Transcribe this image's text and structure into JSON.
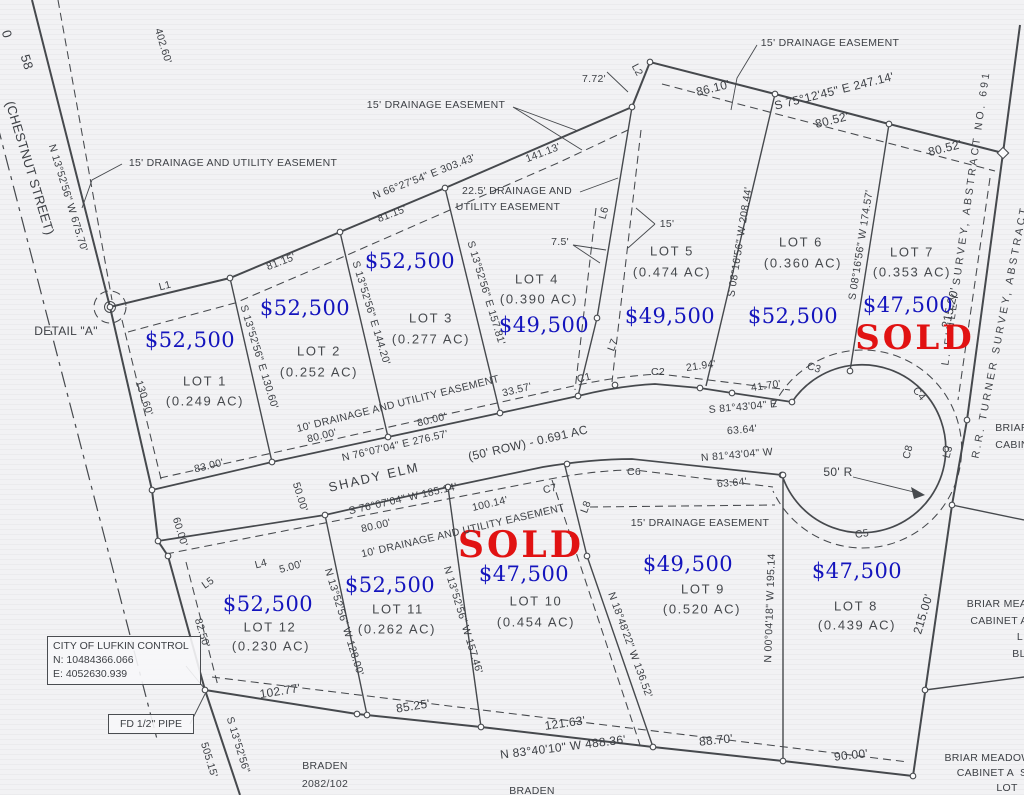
{
  "colors": {
    "price_blue": "#1414bd",
    "sold_red": "#e11212",
    "ink": "#3d4045",
    "paper": "#f2f2f4"
  },
  "control_box": {
    "title": "CITY OF LUFKIN CONTROL",
    "northing": "N: 10484366.066",
    "easting": "E: 4052630.939"
  },
  "pipe_box": {
    "label": "FD 1/2\" PIPE"
  },
  "labels": [
    {
      "n": "dim-402-60",
      "t": "402.60'",
      "x": 163,
      "y": 46,
      "r": 73
    },
    {
      "n": "street-number-partial",
      "t": "0",
      "x": 7,
      "y": 34,
      "r": 73,
      "s": 13
    },
    {
      "n": "street-number",
      "t": "58",
      "x": 27,
      "y": 62,
      "r": 73,
      "s": 13
    },
    {
      "n": "street-name",
      "t": "(CHESTNUT STREET)",
      "x": 30,
      "y": 168,
      "r": 73,
      "s": 13
    },
    {
      "n": "bearing-chestnut",
      "t": "N 13°52'56\" W 675.70'",
      "x": 68,
      "y": 198,
      "r": 73
    },
    {
      "n": "easement-nw-label",
      "t": "15' DRAINAGE AND UTILITY EASEMENT",
      "x": 233,
      "y": 163
    },
    {
      "n": "easement-n-label",
      "t": "15' DRAINAGE EASEMENT",
      "x": 436,
      "y": 105
    },
    {
      "n": "dim-7-72",
      "t": "7.72'",
      "x": 594,
      "y": 79
    },
    {
      "n": "line-l2",
      "t": "L2",
      "x": 637,
      "y": 70,
      "r": 62
    },
    {
      "n": "bearing-n-boundary",
      "t": "N 66°27'54\" E 303.43'",
      "x": 424,
      "y": 177,
      "r": -21
    },
    {
      "n": "dim-141-13",
      "t": "141.13'",
      "x": 543,
      "y": 153,
      "r": -21
    },
    {
      "n": "easement-22-label-1",
      "t": "22.5' DRAINAGE AND",
      "x": 517,
      "y": 191
    },
    {
      "n": "easement-22-label-2",
      "t": "UTILITY EASEMENT",
      "x": 508,
      "y": 207
    },
    {
      "n": "dim-81-15-a",
      "t": "81.15'",
      "x": 281,
      "y": 262,
      "r": -21
    },
    {
      "n": "dim-81-15-b",
      "t": "81.15'",
      "x": 392,
      "y": 214,
      "r": -21
    },
    {
      "n": "easement-ne-label",
      "t": "15' DRAINAGE EASEMENT",
      "x": 830,
      "y": 43
    },
    {
      "n": "dim-86-10",
      "t": "86.10'",
      "x": 713,
      "y": 88,
      "r": -14,
      "s": 12
    },
    {
      "n": "bearing-ne-boundary",
      "t": "S 75°12'45\" E 247.14'",
      "x": 834,
      "y": 91,
      "r": -14,
      "s": 12
    },
    {
      "n": "dim-80-52-a",
      "t": "80.52'",
      "x": 832,
      "y": 120,
      "r": -14,
      "s": 12
    },
    {
      "n": "dim-80-52-b",
      "t": "80.52'",
      "x": 945,
      "y": 148,
      "r": -14,
      "s": 12
    },
    {
      "n": "survey-finley",
      "t": "L. FINLEY SURVEY, ABSTRACT NO. 691",
      "x": 966,
      "y": 218,
      "r": -82,
      "ls": 3
    },
    {
      "n": "survey-turner",
      "t": "R.R. TURNER SURVEY, ABSTRACT",
      "x": 1000,
      "y": 332,
      "r": -79,
      "ls": 3
    },
    {
      "n": "dim-215-20",
      "t": "215.20'",
      "x": 950,
      "y": 308,
      "r": -77,
      "s": 12
    },
    {
      "n": "lot1-price",
      "t": "$52,500",
      "x": 190,
      "y": 340,
      "c": "price"
    },
    {
      "n": "lot1-title",
      "t": "LOT 1",
      "x": 205,
      "y": 381,
      "c": "lot"
    },
    {
      "n": "lot1-area",
      "t": "(0.249 AC)",
      "x": 205,
      "y": 401,
      "c": "lot"
    },
    {
      "n": "lot2-price",
      "t": "$52,500",
      "x": 305,
      "y": 308,
      "c": "price"
    },
    {
      "n": "lot2-title",
      "t": "LOT 2",
      "x": 319,
      "y": 351,
      "c": "lot"
    },
    {
      "n": "lot2-area",
      "t": "(0.252 AC)",
      "x": 319,
      "y": 372,
      "c": "lot"
    },
    {
      "n": "lot3-price",
      "t": "$52,500",
      "x": 410,
      "y": 261,
      "c": "price"
    },
    {
      "n": "lot3-title",
      "t": "LOT 3",
      "x": 431,
      "y": 318,
      "c": "lot"
    },
    {
      "n": "lot3-area",
      "t": "(0.277 AC)",
      "x": 431,
      "y": 339,
      "c": "lot"
    },
    {
      "n": "lot4-title",
      "t": "LOT 4",
      "x": 537,
      "y": 279,
      "c": "lot"
    },
    {
      "n": "lot4-area",
      "t": "(0.390 AC)",
      "x": 539,
      "y": 299,
      "c": "lot"
    },
    {
      "n": "lot4-price",
      "t": "$49,500",
      "x": 544,
      "y": 325,
      "c": "price"
    },
    {
      "n": "lot5-title",
      "t": "LOT 5",
      "x": 672,
      "y": 251,
      "c": "lot"
    },
    {
      "n": "lot5-area",
      "t": "(0.474 AC)",
      "x": 672,
      "y": 272,
      "c": "lot"
    },
    {
      "n": "lot5-price",
      "t": "$49,500",
      "x": 670,
      "y": 316,
      "c": "price"
    },
    {
      "n": "lot6-title",
      "t": "LOT 6",
      "x": 801,
      "y": 242,
      "c": "lot"
    },
    {
      "n": "lot6-area",
      "t": "(0.360 AC)",
      "x": 803,
      "y": 263,
      "c": "lot"
    },
    {
      "n": "lot6-price",
      "t": "$52,500",
      "x": 793,
      "y": 316,
      "c": "price"
    },
    {
      "n": "lot7-title",
      "t": "LOT 7",
      "x": 912,
      "y": 252,
      "c": "lot"
    },
    {
      "n": "lot7-area",
      "t": "(0.353 AC)",
      "x": 912,
      "y": 272,
      "c": "lot"
    },
    {
      "n": "lot7-price",
      "t": "$47,500",
      "x": 908,
      "y": 305,
      "c": "price"
    },
    {
      "n": "lot7-sold",
      "t": "SOLD",
      "x": 915,
      "y": 338,
      "c": "sold",
      "s": 34
    },
    {
      "n": "lot8-price",
      "t": "$47,500",
      "x": 857,
      "y": 571,
      "c": "price"
    },
    {
      "n": "lot8-title",
      "t": "LOT 8",
      "x": 856,
      "y": 606,
      "c": "lot"
    },
    {
      "n": "lot8-area",
      "t": "(0.439 AC)",
      "x": 857,
      "y": 625,
      "c": "lot"
    },
    {
      "n": "lot9-price",
      "t": "$49,500",
      "x": 688,
      "y": 564,
      "c": "price"
    },
    {
      "n": "lot9-title",
      "t": "LOT 9",
      "x": 703,
      "y": 589,
      "c": "lot"
    },
    {
      "n": "lot9-area",
      "t": "(0.520 AC)",
      "x": 702,
      "y": 609,
      "c": "lot"
    },
    {
      "n": "lot10-sold",
      "t": "SOLD",
      "x": 521,
      "y": 545,
      "c": "sold",
      "s": 36
    },
    {
      "n": "lot10-price",
      "t": "$47,500",
      "x": 524,
      "y": 574,
      "c": "price"
    },
    {
      "n": "lot10-title",
      "t": "LOT 10",
      "x": 536,
      "y": 601,
      "c": "lot"
    },
    {
      "n": "lot10-area",
      "t": "(0.454 AC)",
      "x": 536,
      "y": 622,
      "c": "lot"
    },
    {
      "n": "lot11-price",
      "t": "$52,500",
      "x": 390,
      "y": 585,
      "c": "price"
    },
    {
      "n": "lot11-title",
      "t": "LOT 11",
      "x": 398,
      "y": 609,
      "c": "lot"
    },
    {
      "n": "lot11-area",
      "t": "(0.262 AC)",
      "x": 397,
      "y": 629,
      "c": "lot"
    },
    {
      "n": "lot12-price",
      "t": "$52,500",
      "x": 268,
      "y": 604,
      "c": "price"
    },
    {
      "n": "lot12-title",
      "t": "LOT 12",
      "x": 270,
      "y": 627,
      "c": "lot"
    },
    {
      "n": "lot12-area",
      "t": "(0.230 AC)",
      "x": 271,
      "y": 646,
      "c": "lot"
    },
    {
      "n": "bearing-lot1-2",
      "t": "S 13°52'56\" E 130.60'",
      "x": 259,
      "y": 357,
      "r": 73
    },
    {
      "n": "bearing-lot2-3",
      "t": "S 13°52'56\" E 144.20'",
      "x": 371,
      "y": 313,
      "r": 73
    },
    {
      "n": "bearing-lot3-4",
      "t": "S 13°52'56\" E 157.81'",
      "x": 486,
      "y": 293,
      "r": 73
    },
    {
      "n": "bearing-lot5-6",
      "t": "S 08°16'56\" W 208.44'",
      "x": 740,
      "y": 242,
      "r": -81
    },
    {
      "n": "bearing-lot6-7",
      "t": "S 08°16'56\" W 174.57'",
      "x": 861,
      "y": 245,
      "r": -81
    },
    {
      "n": "bearing-lot12-11",
      "t": "N 13°52'56\" W 128.00'",
      "x": 344,
      "y": 622,
      "r": 73
    },
    {
      "n": "bearing-lot11-10",
      "t": "N 13°52'56\" W 157.46'",
      "x": 463,
      "y": 620,
      "r": 73
    },
    {
      "n": "bearing-lot10-9",
      "t": "N 18°48'22\" W 136.52'",
      "x": 630,
      "y": 645,
      "r": 70
    },
    {
      "n": "bearing-lot9-8",
      "t": "N 00°04'18\" W 195.14",
      "x": 770,
      "y": 608,
      "r": -88
    },
    {
      "n": "line-l1",
      "t": "L1",
      "x": 165,
      "y": 286,
      "r": -15
    },
    {
      "n": "detail-a-label",
      "t": "DETAIL \"A\"",
      "x": 66,
      "y": 331,
      "s": 12
    },
    {
      "n": "dim-130-60",
      "t": "130.60'",
      "x": 144,
      "y": 398,
      "r": 72
    },
    {
      "n": "dim-83-00",
      "t": "83.00'",
      "x": 209,
      "y": 466,
      "r": -14
    },
    {
      "n": "easement-10-north",
      "t": "10' DRAINAGE AND UTILITY EASEMENT",
      "x": 398,
      "y": 404,
      "r": -14
    },
    {
      "n": "dim-80-00-a",
      "t": "80.00'",
      "x": 322,
      "y": 436,
      "r": -14
    },
    {
      "n": "dim-80-00-b",
      "t": "80.00'",
      "x": 432,
      "y": 420,
      "r": -14
    },
    {
      "n": "dim-33-57",
      "t": "33.57'",
      "x": 517,
      "y": 390,
      "r": -14
    },
    {
      "n": "curve-c1",
      "t": "C1",
      "x": 584,
      "y": 378,
      "r": -14
    },
    {
      "n": "curve-c2",
      "t": "C2",
      "x": 658,
      "y": 372
    },
    {
      "n": "dim-21-94",
      "t": "21.94'",
      "x": 701,
      "y": 366,
      "r": -8
    },
    {
      "n": "dim-41-70",
      "t": "41.70'",
      "x": 766,
      "y": 386,
      "r": -8
    },
    {
      "n": "curve-c3",
      "t": "C3",
      "x": 814,
      "y": 368,
      "r": 18
    },
    {
      "n": "bearing-s8143",
      "t": "S 81°43'04\" E",
      "x": 743,
      "y": 407,
      "r": -5
    },
    {
      "n": "dim-63-64-a",
      "t": "63.64'",
      "x": 742,
      "y": 430,
      "r": -5
    },
    {
      "n": "bearing-n8143",
      "t": "N 81°43'04\" W",
      "x": 737,
      "y": 455,
      "r": -5
    },
    {
      "n": "dim-63-64-b",
      "t": "63.64'",
      "x": 732,
      "y": 483,
      "r": -5
    },
    {
      "n": "curve-c6",
      "t": "C6",
      "x": 634,
      "y": 472
    },
    {
      "n": "radius-50",
      "t": "50' R",
      "x": 838,
      "y": 472,
      "s": 12
    },
    {
      "n": "curve-c8",
      "t": "C8",
      "x": 908,
      "y": 452,
      "r": -75
    },
    {
      "n": "curve-c4",
      "t": "C4",
      "x": 919,
      "y": 394,
      "r": 50
    },
    {
      "n": "curve-c5",
      "t": "C5",
      "x": 862,
      "y": 534,
      "r": -8
    },
    {
      "n": "line-l3",
      "t": "L3",
      "x": 948,
      "y": 452,
      "r": -75
    },
    {
      "n": "bearing-shady-n",
      "t": "N 76°07'04\" E 276.57'",
      "x": 395,
      "y": 446,
      "r": -13
    },
    {
      "n": "road-name",
      "t": "SHADY ELM",
      "x": 374,
      "y": 477,
      "r": -13,
      "s": 13,
      "ls": 2
    },
    {
      "n": "road-row",
      "t": "(50' ROW) - 0.691 AC",
      "x": 528,
      "y": 443,
      "r": -13,
      "s": 12
    },
    {
      "n": "bearing-shady-s",
      "t": "S 76°07'04\" W 185.14'",
      "x": 403,
      "y": 499,
      "r": -13
    },
    {
      "n": "dim-50-00",
      "t": "50.00'",
      "x": 300,
      "y": 497,
      "r": 73
    },
    {
      "n": "dim-100-14",
      "t": "100.14'",
      "x": 490,
      "y": 504,
      "r": -13
    },
    {
      "n": "curve-c7",
      "t": "C7",
      "x": 550,
      "y": 489,
      "r": -13
    },
    {
      "n": "line-l8",
      "t": "L8",
      "x": 586,
      "y": 507,
      "r": -70
    },
    {
      "n": "easement-15-south",
      "t": "15' DRAINAGE EASEMENT",
      "x": 700,
      "y": 523
    },
    {
      "n": "dim-80-00-c",
      "t": "80.00'",
      "x": 376,
      "y": 526,
      "r": -13
    },
    {
      "n": "easement-10-south",
      "t": "10' DRAINAGE AND UTILITY EASEMENT",
      "x": 463,
      "y": 531,
      "r": -13
    },
    {
      "n": "line-l4",
      "t": "L4",
      "x": 261,
      "y": 564,
      "r": -15
    },
    {
      "n": "dim-5-00",
      "t": "5.00'",
      "x": 291,
      "y": 567,
      "r": -15
    },
    {
      "n": "line-l5",
      "t": "L5",
      "x": 208,
      "y": 583,
      "r": -35
    },
    {
      "n": "dim-82-50",
      "t": "82.50'",
      "x": 202,
      "y": 633,
      "r": 73
    },
    {
      "n": "dim-60-00",
      "t": "60.00'",
      "x": 180,
      "y": 532,
      "r": 73
    },
    {
      "n": "dim-102-77",
      "t": "102.77'",
      "x": 280,
      "y": 691,
      "r": -9,
      "s": 12
    },
    {
      "n": "dim-85-25",
      "t": "85.25'",
      "x": 413,
      "y": 706,
      "r": -9,
      "s": 12
    },
    {
      "n": "dim-121-63",
      "t": "121.63'",
      "x": 565,
      "y": 723,
      "r": -8,
      "s": 12
    },
    {
      "n": "bearing-south-boundary",
      "t": "N 83°40'10\" W 488.36'",
      "x": 563,
      "y": 747,
      "r": -7,
      "s": 12
    },
    {
      "n": "dim-88-70",
      "t": "88.70'",
      "x": 716,
      "y": 740,
      "r": -6,
      "s": 12
    },
    {
      "n": "dim-90-00",
      "t": "90.00'",
      "x": 851,
      "y": 755,
      "r": -6,
      "s": 12
    },
    {
      "n": "dim-215-00",
      "t": "215.00'",
      "x": 923,
      "y": 614,
      "r": -73,
      "s": 12
    },
    {
      "n": "bearing-sw",
      "t": "S 13°52'56\"",
      "x": 238,
      "y": 745,
      "r": 73
    },
    {
      "n": "dim-505-15",
      "t": "505.15'",
      "x": 209,
      "y": 760,
      "r": 73
    },
    {
      "n": "braden-label-1a",
      "t": "BRADEN",
      "x": 325,
      "y": 766
    },
    {
      "n": "braden-label-1b",
      "t": "2082/102",
      "x": 325,
      "y": 784
    },
    {
      "n": "braden-label-1c",
      "t": "0.50 ACRE",
      "x": 325,
      "y": 801
    },
    {
      "n": "braden-label-2",
      "t": "BRADEN",
      "x": 532,
      "y": 791
    },
    {
      "n": "dim-7-5",
      "t": "7.5'",
      "x": 560,
      "y": 242
    },
    {
      "n": "dim-15-lot5",
      "t": "15'",
      "x": 667,
      "y": 224
    },
    {
      "n": "line-l6",
      "t": "L6",
      "x": 604,
      "y": 213,
      "r": -75
    },
    {
      "n": "line-l7",
      "t": "L7",
      "x": 613,
      "y": 345,
      "r": -70
    },
    {
      "n": "briar-frag-1a",
      "t": "BRIAR",
      "x": 1012,
      "y": 428
    },
    {
      "n": "briar-frag-1b",
      "t": "CABIN",
      "x": 1012,
      "y": 445
    },
    {
      "n": "briar-frag-2a",
      "t": "BRIAR MEA",
      "x": 997,
      "y": 604
    },
    {
      "n": "briar-frag-2b",
      "t": "CABINET A",
      "x": 999,
      "y": 621
    },
    {
      "n": "briar-frag-2c",
      "t": "L",
      "x": 1020,
      "y": 637
    },
    {
      "n": "briar-frag-2d",
      "t": "BL",
      "x": 1019,
      "y": 654
    },
    {
      "n": "briar-frag-3a",
      "t": "BRIAR MEADOW",
      "x": 988,
      "y": 758
    },
    {
      "n": "briar-frag-3b",
      "t": "CABINET A  S",
      "x": 992,
      "y": 773
    },
    {
      "n": "briar-frag-3c",
      "t": "LOT",
      "x": 1007,
      "y": 788
    }
  ]
}
